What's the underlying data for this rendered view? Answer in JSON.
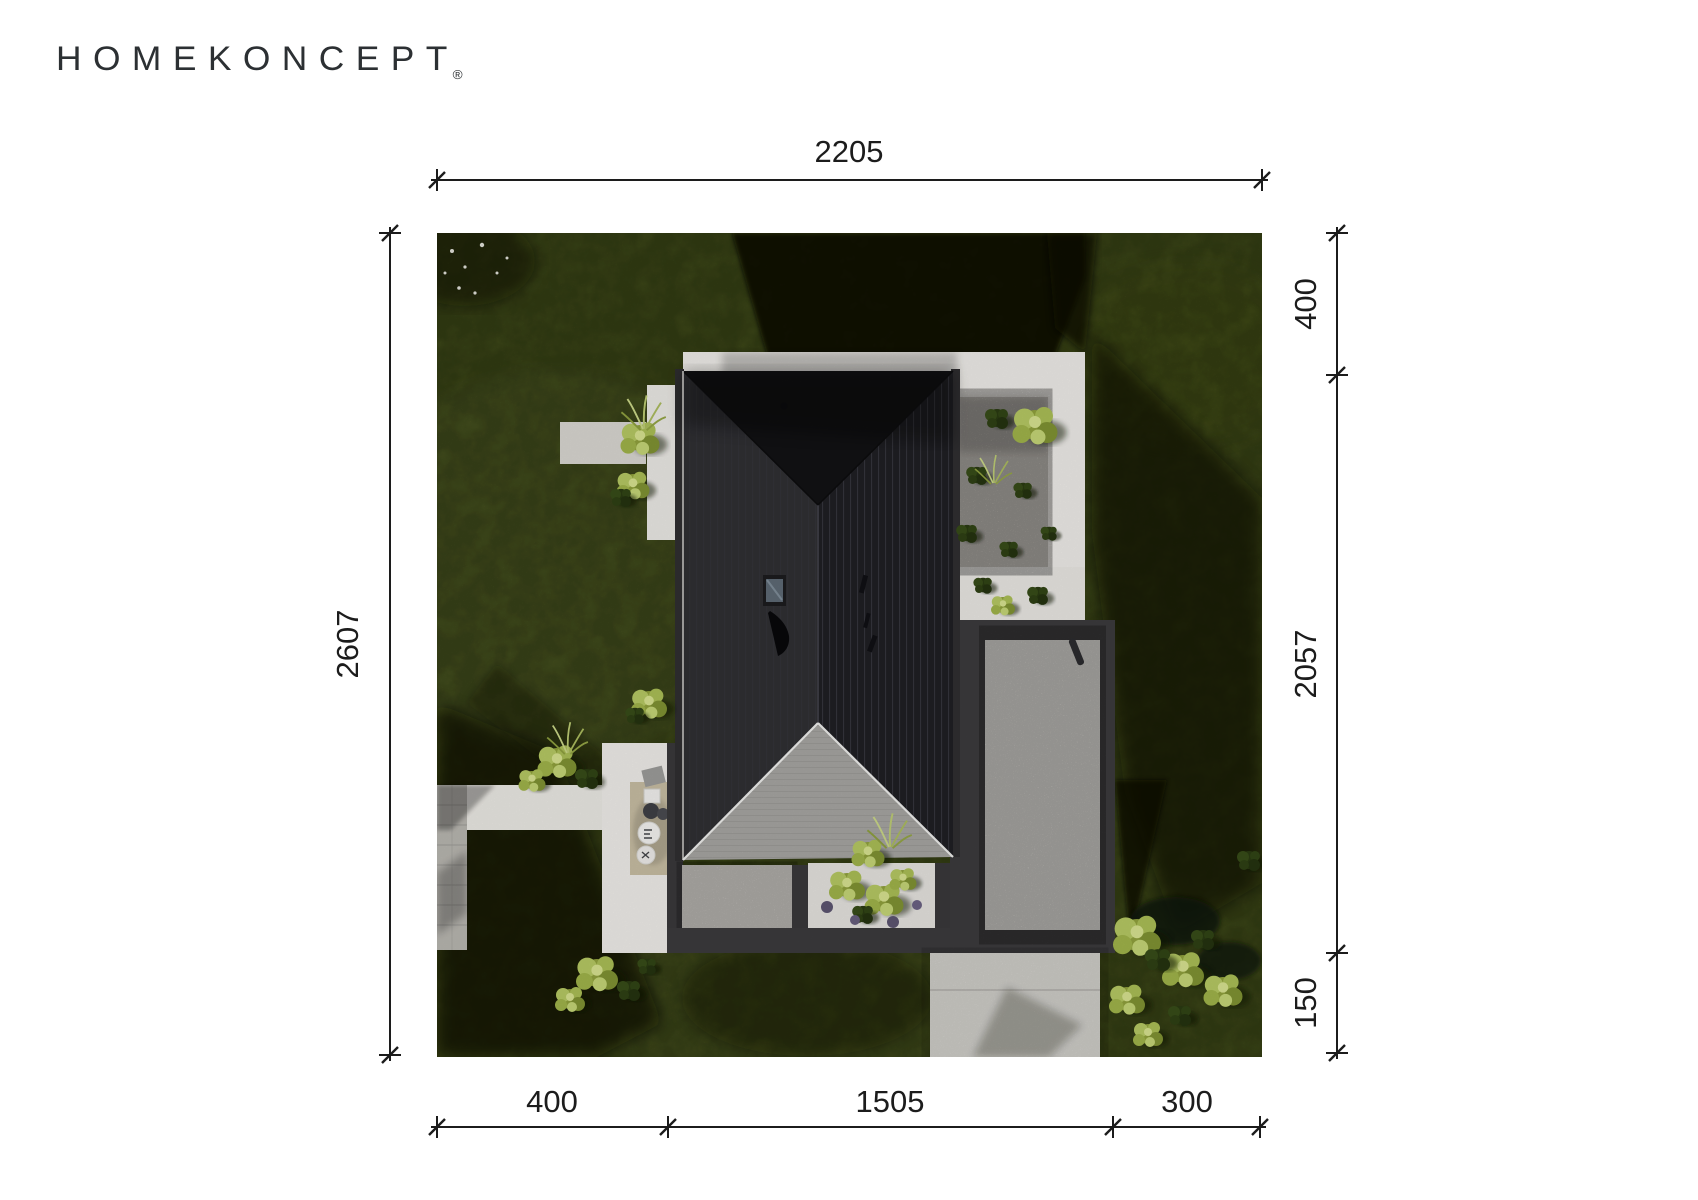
{
  "brand": {
    "logo_text": "HOMEKONCEPT",
    "registered_mark": "®"
  },
  "drawing": {
    "type": "site-plan-aerial-view",
    "subject": "Top-down rendering of a single-family house with a dark hip roof, white terraces, gravel court, planter and driveway on a green lawn plot",
    "units": "cm",
    "dimensions": {
      "top": {
        "label": "2205"
      },
      "left": {
        "label": "2607"
      },
      "right": [
        {
          "label": "400"
        },
        {
          "label": "2057"
        },
        {
          "label": "150"
        }
      ],
      "bottom": [
        {
          "label": "400"
        },
        {
          "label": "1505"
        },
        {
          "label": "300"
        }
      ]
    },
    "colors": {
      "page_bg": "#ffffff",
      "dimension_ink": "#1c1c1c",
      "lawn_green": "#4f5d1f",
      "roof_dark": "#1f1f23",
      "terrace_roof_gray": "#a5a4a1",
      "paving_white": "#edebe7",
      "shadow_dark": "#0b1005"
    }
  }
}
